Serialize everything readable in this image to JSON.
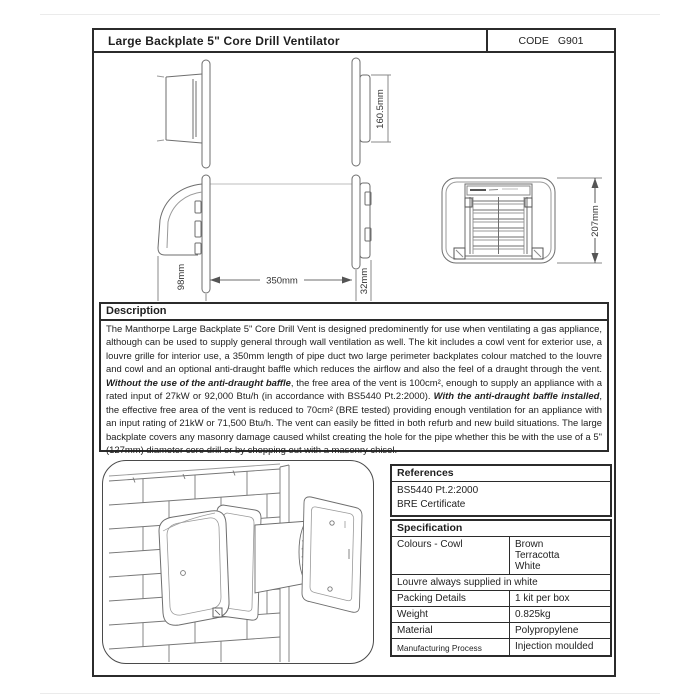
{
  "header": {
    "title": "Large Backplate 5\" Core Drill Ventilator",
    "code_label": "CODE",
    "code_value": "G901"
  },
  "drawings": {
    "dim_160": "160.5mm",
    "dim_98": "98mm",
    "dim_350": "350mm",
    "dim_32": "32mm",
    "dim_207": "207mm"
  },
  "description": {
    "heading": "Description",
    "seg1": "The Manthorpe Large Backplate 5\" Core Drill Vent is designed predominently for use when ventilating a gas appliance, although can be used to supply general through wall ventilation as well. The kit includes a cowl vent for exterior use, a louvre grille for interior use, a 350mm length of pipe duct two large perimeter backplates colour matched to the louvre and cowl and an optional anti-draught baffle which reduces the airflow and also the feel of a draught through the vent. ",
    "bold1": "Without the use of the anti-draught baffle",
    "seg2": ", the free area of the vent is 100cm², enough to supply an appliance with a rated input of 27kW or 92,000 Btu/h (in accordance with BS5440 Pt.2:2000). ",
    "bold2": "With the anti-draught baffle installed",
    "seg3": ", the effective free area of the vent is reduced to 70cm² (BRE tested) providing enough ventilation for an appliance with an input rating of 21kW or 71,500 Btu/h. The vent can easily be fitted in both refurb and new build situations. The large backplate covers any masonry damage caused whilst creating the hole for the pipe whether this be with  the use of a 5\" (127mm) diameter core drill or by chopping out with a masonry chisel."
  },
  "references": {
    "heading": "References",
    "item1": "BS5440 Pt.2:2000",
    "item2": "BRE Certificate"
  },
  "specification": {
    "heading": "Specification",
    "colours_label": "Colours - Cowl",
    "colour1": "Brown",
    "colour2": "Terracotta",
    "colour3": "White",
    "louvre_note": "Louvre always supplied in white",
    "rows": [
      {
        "label": "Packing Details",
        "value": "1 kit per box"
      },
      {
        "label": "Weight",
        "value": "0.825kg"
      },
      {
        "label": "Material",
        "value": "Polypropylene"
      },
      {
        "label": "Manufacturing Process",
        "value": "Injection moulded"
      }
    ]
  }
}
